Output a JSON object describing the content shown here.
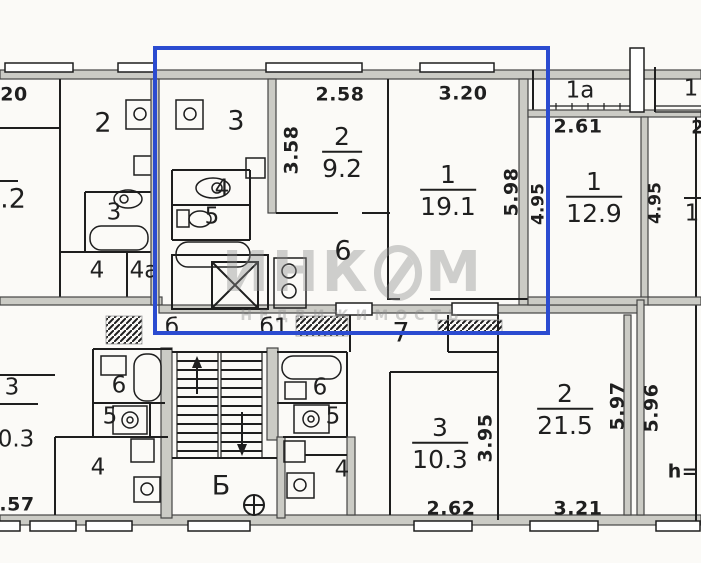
{
  "plan": {
    "watermark": {
      "part1": "ИНК",
      "part2": "М",
      "subtext": "НЕДВИЖИМОСТЬ"
    },
    "highlight_color": "#2b4bd0",
    "left_apartment": {
      "dim_top_partial": "20",
      "room2": "2",
      "room3": "3",
      "room4": "4",
      "room4a": "4а",
      "area_partial": ".2"
    },
    "highlighted_apartment": {
      "dim_room2_width": "2.58",
      "dim_room1_width": "3.20",
      "dim_room2_depth": "3.58",
      "dim_room1_depth": "5.98",
      "dim_adjacent_depth": "4.95",
      "room3": "3",
      "room4": "4",
      "room5": "5",
      "room6": "6",
      "room2_num": "2",
      "room2_area": "9.2",
      "room1_num": "1",
      "room1_area": "19.1",
      "hall_b": "б",
      "hall_b1": "б1"
    },
    "right_apartment": {
      "loggia": "1а",
      "dim_loggia": "2.61",
      "room1_num": "1",
      "room1_area": "12.9",
      "dim_depth": "4.95",
      "corner_label": "1",
      "edge_dim_partial": "2",
      "edge_room_partial": "1"
    },
    "stairwell": {
      "hall": "Б"
    },
    "bottom_left_apartment": {
      "room6": "6",
      "room5": "5",
      "room4": "4",
      "room3_num": "3",
      "room3_area_partial": "0.3",
      "dim_bottom_partial": ".57"
    },
    "bottom_middle_apartment": {
      "room4": "4"
    },
    "bottom_right_apartment": {
      "hall7": "7",
      "room6": "6",
      "room5": "5",
      "room3_num": "3",
      "room3_area": "10.3",
      "dim_room3_depth": "3.95",
      "dim_room3_width": "2.62",
      "room2_num": "2",
      "room2_area": "21.5",
      "dim_room2_width": "3.21",
      "dim_room2_depth": "5.97"
    },
    "far_right_apartment": {
      "dim_depth": "5.96",
      "height_label_partial": "h="
    }
  }
}
